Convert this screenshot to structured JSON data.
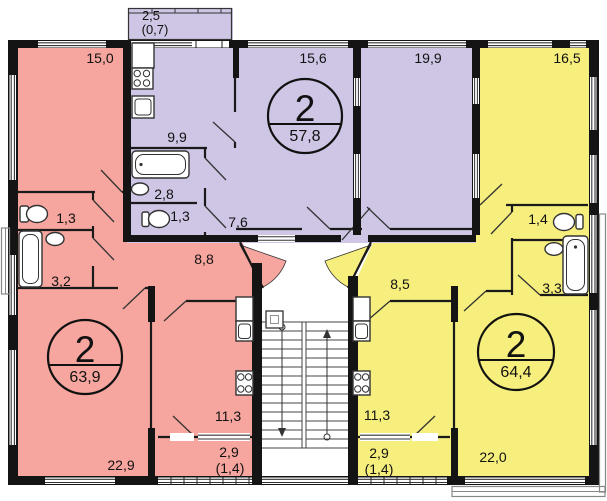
{
  "colors": {
    "pink": "#f6a69e",
    "purple": "#cfc6e5",
    "yellow": "#f6ee7d",
    "wall": "#141414"
  },
  "apartments": {
    "left": {
      "rooms_count": "2",
      "total_area": "63,9",
      "rooms": {
        "room": "15,0",
        "wc": "1,3",
        "bath": "3,2",
        "hall": "8,8",
        "living": "22,9",
        "kitchen": "11,3",
        "balcony": "2,9",
        "balcony_reduced": "(1,4)"
      }
    },
    "center": {
      "rooms_count": "2",
      "total_area": "57,8",
      "rooms": {
        "balcony": "2,5",
        "balcony_reduced": "(0,7)",
        "kitchen": "9,9",
        "bath": "2,8",
        "wc": "1,3",
        "hall": "7,6",
        "bedroom": "15,6",
        "living": "19,9"
      }
    },
    "right": {
      "rooms_count": "2",
      "total_area": "64,4",
      "rooms": {
        "room": "16,5",
        "wc": "1,4",
        "bath": "3,3",
        "hall": "8,5",
        "kitchen": "11,3",
        "balcony": "2,9",
        "balcony_reduced": "(1,4)",
        "living": "22,0"
      }
    }
  }
}
